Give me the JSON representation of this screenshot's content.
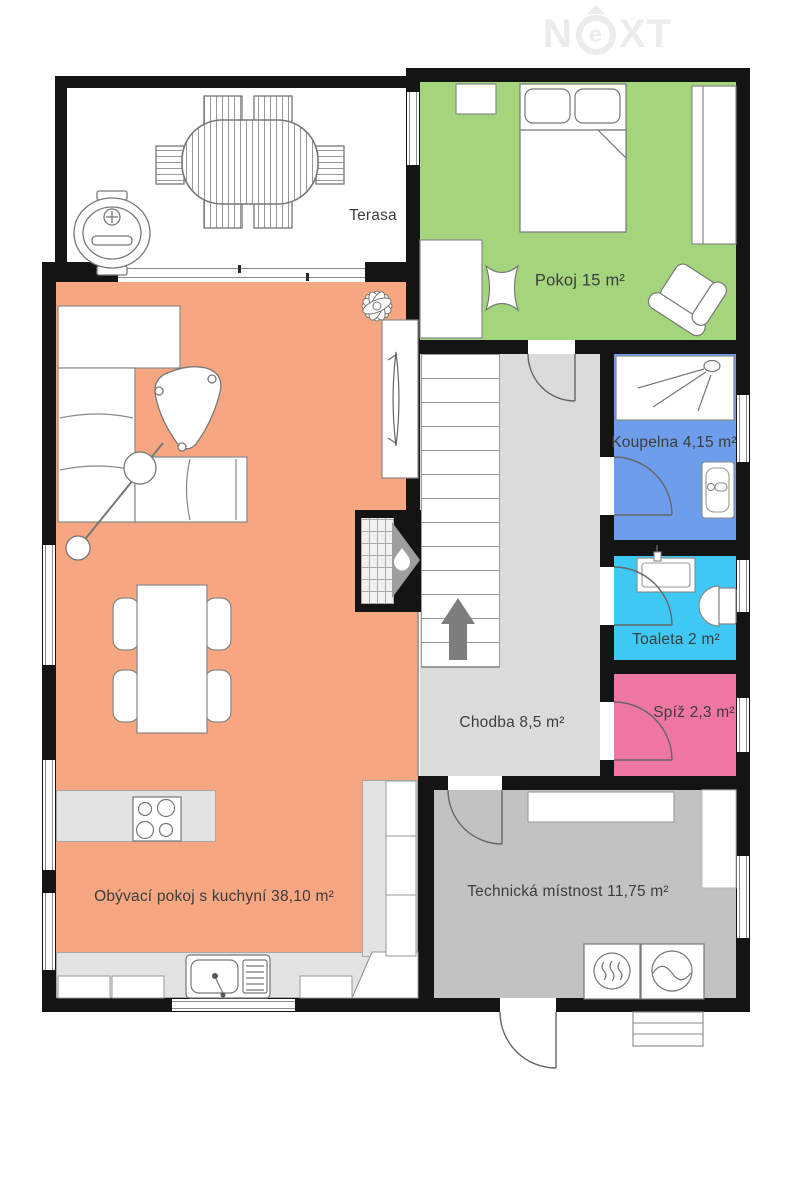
{
  "brand": {
    "n": "N",
    "e": "e",
    "xt": "XT"
  },
  "rooms": {
    "terasa": {
      "label": "Terasa",
      "color": "#ffffff"
    },
    "pokoj": {
      "label": "Pokoj 15 m²",
      "color": "#a4d57d"
    },
    "koupelna": {
      "label": "Koupelna 4,15 m²",
      "color": "#6e9eeb"
    },
    "toaleta": {
      "label": "Toaleta 2 m²",
      "color": "#3ec8f3"
    },
    "spiz": {
      "label": "Spíž 2,3 m²",
      "color": "#ee76a0"
    },
    "chodba": {
      "label": "Chodba 8,5 m²",
      "color": "#dbdbdb"
    },
    "obyvaci": {
      "label": "Obývací pokoj s kuchyní 38,10 m²",
      "color": "#f6a680"
    },
    "technicka": {
      "label": "Technická místnost 11,75 m²",
      "color": "#c2c2c2"
    }
  },
  "palette": {
    "wall": "#141414",
    "counter": "#e3e3e3",
    "outline": "#858585",
    "label_text": "#3d3d3d",
    "logo": "#ececec",
    "stairs_arrow": "#7d7d7d",
    "fireplace_accent": "#9e9e9e"
  }
}
